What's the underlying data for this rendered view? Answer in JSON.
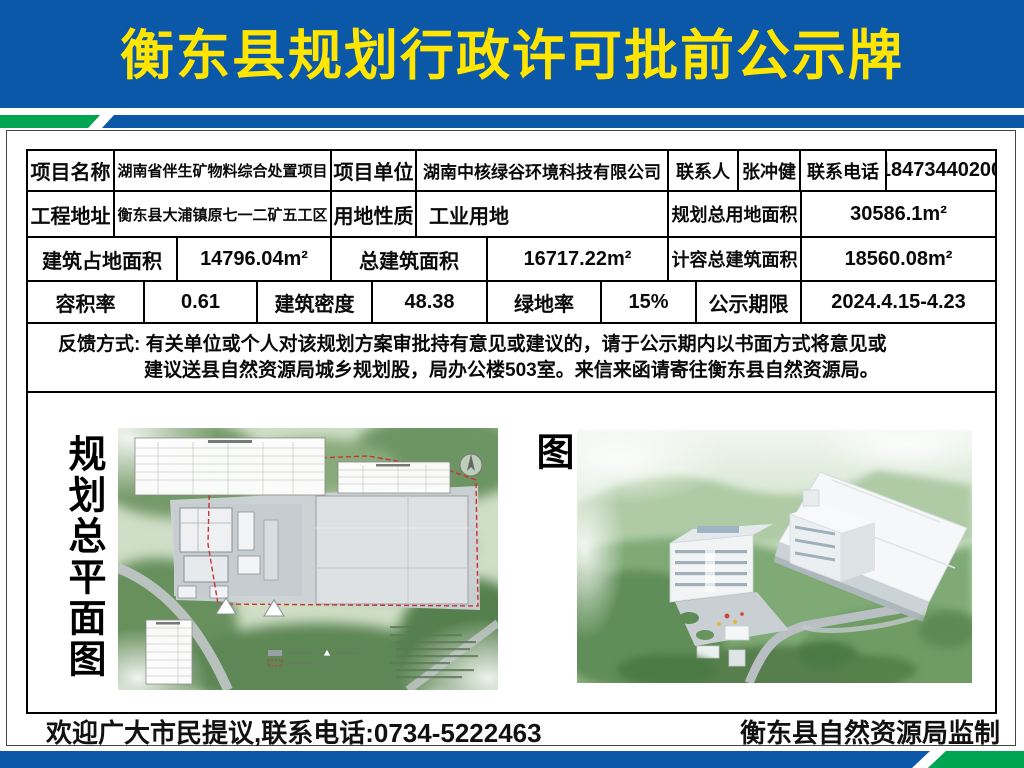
{
  "header": {
    "title": "衡东县规划行政许可批前公示牌"
  },
  "colors": {
    "header_blue": "#0b57a8",
    "stripe_green": "#00a551",
    "title_yellow": "#ffe500"
  },
  "table": {
    "row1": {
      "c1": "项目名称",
      "v1": "湖南省伴生矿物料综合处置项目",
      "c2": "项目单位",
      "v2": "湖南中核绿谷环境科技有限公司",
      "c3": "联系人",
      "v3": "张冲健",
      "c4": "联系电话",
      "v4": "18473440200"
    },
    "row2": {
      "c1": "工程地址",
      "v1": "衡东县大浦镇原七一二矿五工区",
      "c2": "用地性质",
      "v2": "工业用地",
      "c3": "规划总用地面积",
      "v3": "30586.1m²"
    },
    "row3": {
      "c1": "建筑占地面积",
      "v1": "14796.04m²",
      "c2": "总建筑面积",
      "v2": "16717.22m²",
      "c3": "计容总建筑面积",
      "v3": "18560.08m²"
    },
    "row4": {
      "c1": "容积率",
      "v1": "0.61",
      "c2": "建筑密度",
      "v2": "48.38",
      "c3": "绿地率",
      "v3": "15%",
      "c4": "公示期限",
      "v4": "2024.4.15-4.23"
    },
    "feedback": {
      "line1": "反馈方式: 有关单位或个人对该规划方案审批持有意见或建议的，请于公示期内以书面方式将意见或",
      "line2": "建议送县自然资源局城乡规划股，局办公楼503室。来信来函请寄往衡东县自然资源局。"
    }
  },
  "figures": {
    "left_label": "规划总平面图",
    "right_label": "项目鸟瞰图",
    "compass_icon": "north-compass"
  },
  "footer": {
    "left": "欢迎广大市民提议,联系电话:0734-5222463",
    "right": "衡东县自然资源局监制"
  }
}
